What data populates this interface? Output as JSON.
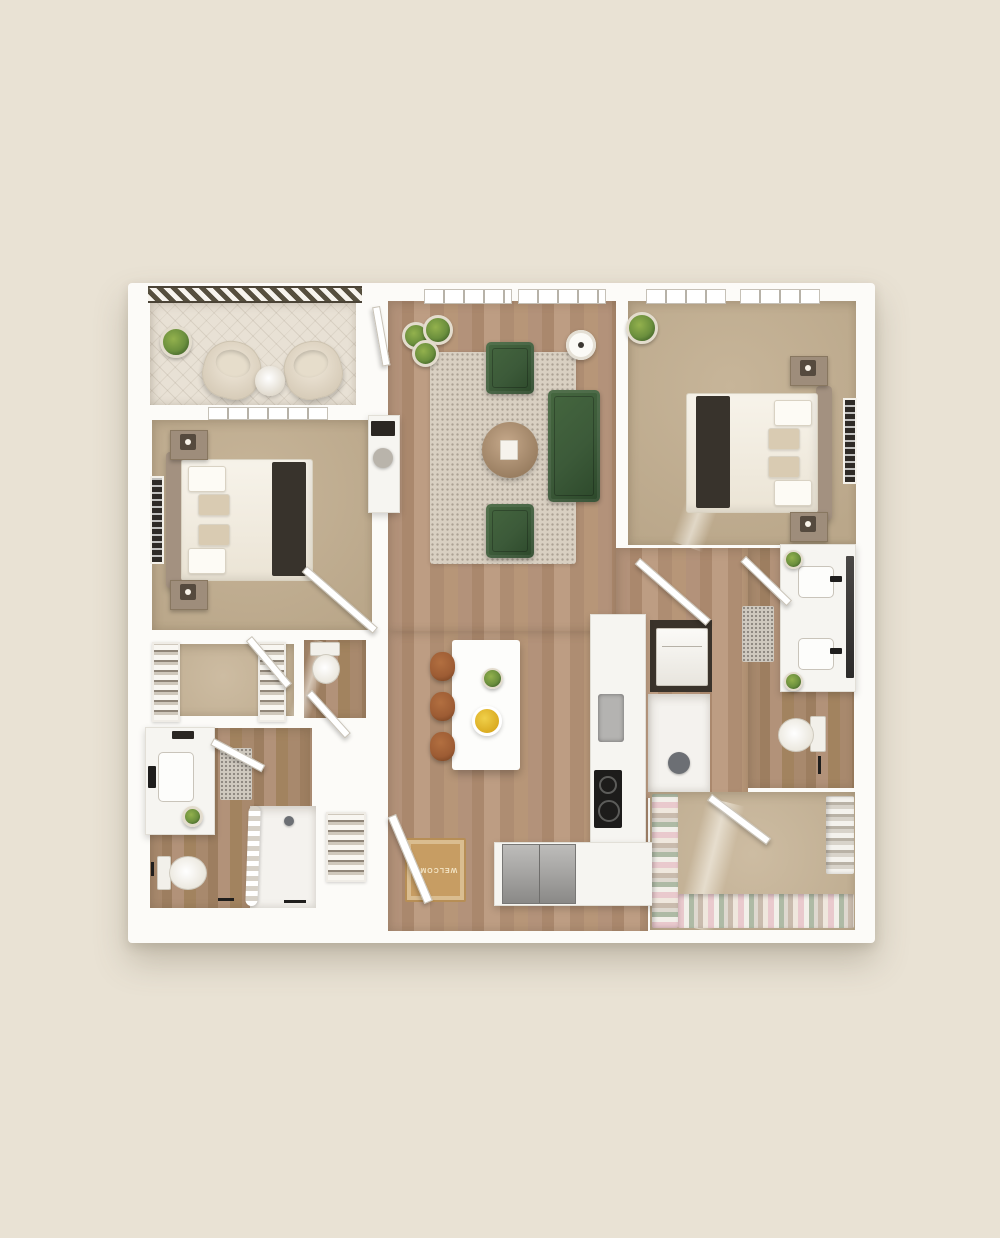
{
  "scene": {
    "kind": "3d-rendered-apartment-floor-plan",
    "view": "top-down",
    "plan_style": "white walls on beige background"
  },
  "entry_mat": {
    "text": "WELCOME"
  },
  "colors": {
    "bg": "#e9e2d4",
    "wall": "#fcfbf8",
    "wood": "#b3927a",
    "wood_dark": "#a8896d",
    "carpet": "#c7b599",
    "carpet_light": "#cdbca2",
    "tile": "#e8e1d5",
    "rug": "#d9d0c2",
    "sofa": "#3c5a39",
    "plant": "#6b8f3d",
    "stool": "#9d5c34",
    "steel": "#a7a6a4",
    "cooktop": "#1d1c1b",
    "mat": "#c79d63",
    "mat_text": "#f3e4c4",
    "throw": "#38332c",
    "taupe": "#a39180",
    "frame": "#2e2a26"
  },
  "rooms": [
    {
      "id": "balcony",
      "floor": "tile",
      "features": [
        "hatched-railing"
      ],
      "furniture": [
        "lounge-chair",
        "lounge-chair",
        "round-side-table",
        "potted-plant"
      ]
    },
    {
      "id": "living-room",
      "floor": "wood",
      "features": [
        "windows",
        "balcony-door"
      ],
      "furniture": [
        "area-rug",
        "sofa",
        "armchair",
        "armchair",
        "round-coffee-table",
        "floor-lamp",
        "potted-plants",
        "desk-nook"
      ]
    },
    {
      "id": "bedroom-1",
      "floor": "carpet",
      "features": [
        "window-to-balcony",
        "door"
      ],
      "furniture": [
        "bed",
        "nightstand",
        "nightstand",
        "wall-art"
      ]
    },
    {
      "id": "bedroom-2",
      "floor": "carpet",
      "features": [
        "windows",
        "door"
      ],
      "furniture": [
        "bed",
        "nightstand",
        "nightstand",
        "wall-art",
        "potted-plant"
      ]
    },
    {
      "id": "walk-in-closet-1",
      "floor": "carpet",
      "furniture": [
        "shelving-unit",
        "shelving-unit"
      ]
    },
    {
      "id": "powder-room",
      "floor": "wood",
      "furniture": [
        "toilet"
      ]
    },
    {
      "id": "bathroom-1",
      "floor": "wood",
      "furniture": [
        "vanity-with-sink",
        "toilet",
        "bath-mat",
        "shower-with-curtain",
        "linen-shelves",
        "towel-bars"
      ]
    },
    {
      "id": "kitchen",
      "floor": "wood",
      "furniture": [
        "island",
        "bar-stool",
        "bar-stool",
        "bar-stool",
        "sink",
        "cooktop",
        "counter-run",
        "refrigerator",
        "lemon-bowl",
        "potted-plant"
      ]
    },
    {
      "id": "laundry-nook",
      "furniture": [
        "stacked-washer-dryer"
      ]
    },
    {
      "id": "bathroom-2",
      "floor": "wood",
      "furniture": [
        "double-vanity",
        "mirror",
        "toilet",
        "bath-mat",
        "walk-in-shower",
        "potted-plant",
        "potted-plant"
      ]
    },
    {
      "id": "walk-in-closet-2",
      "floor": "carpet",
      "furniture": [
        "hanging-clothes-rail",
        "hanging-clothes-rail",
        "hanging-clothes-rail"
      ]
    },
    {
      "id": "entry",
      "floor": "wood",
      "furniture": [
        "welcome-mat",
        "entry-door"
      ]
    }
  ]
}
